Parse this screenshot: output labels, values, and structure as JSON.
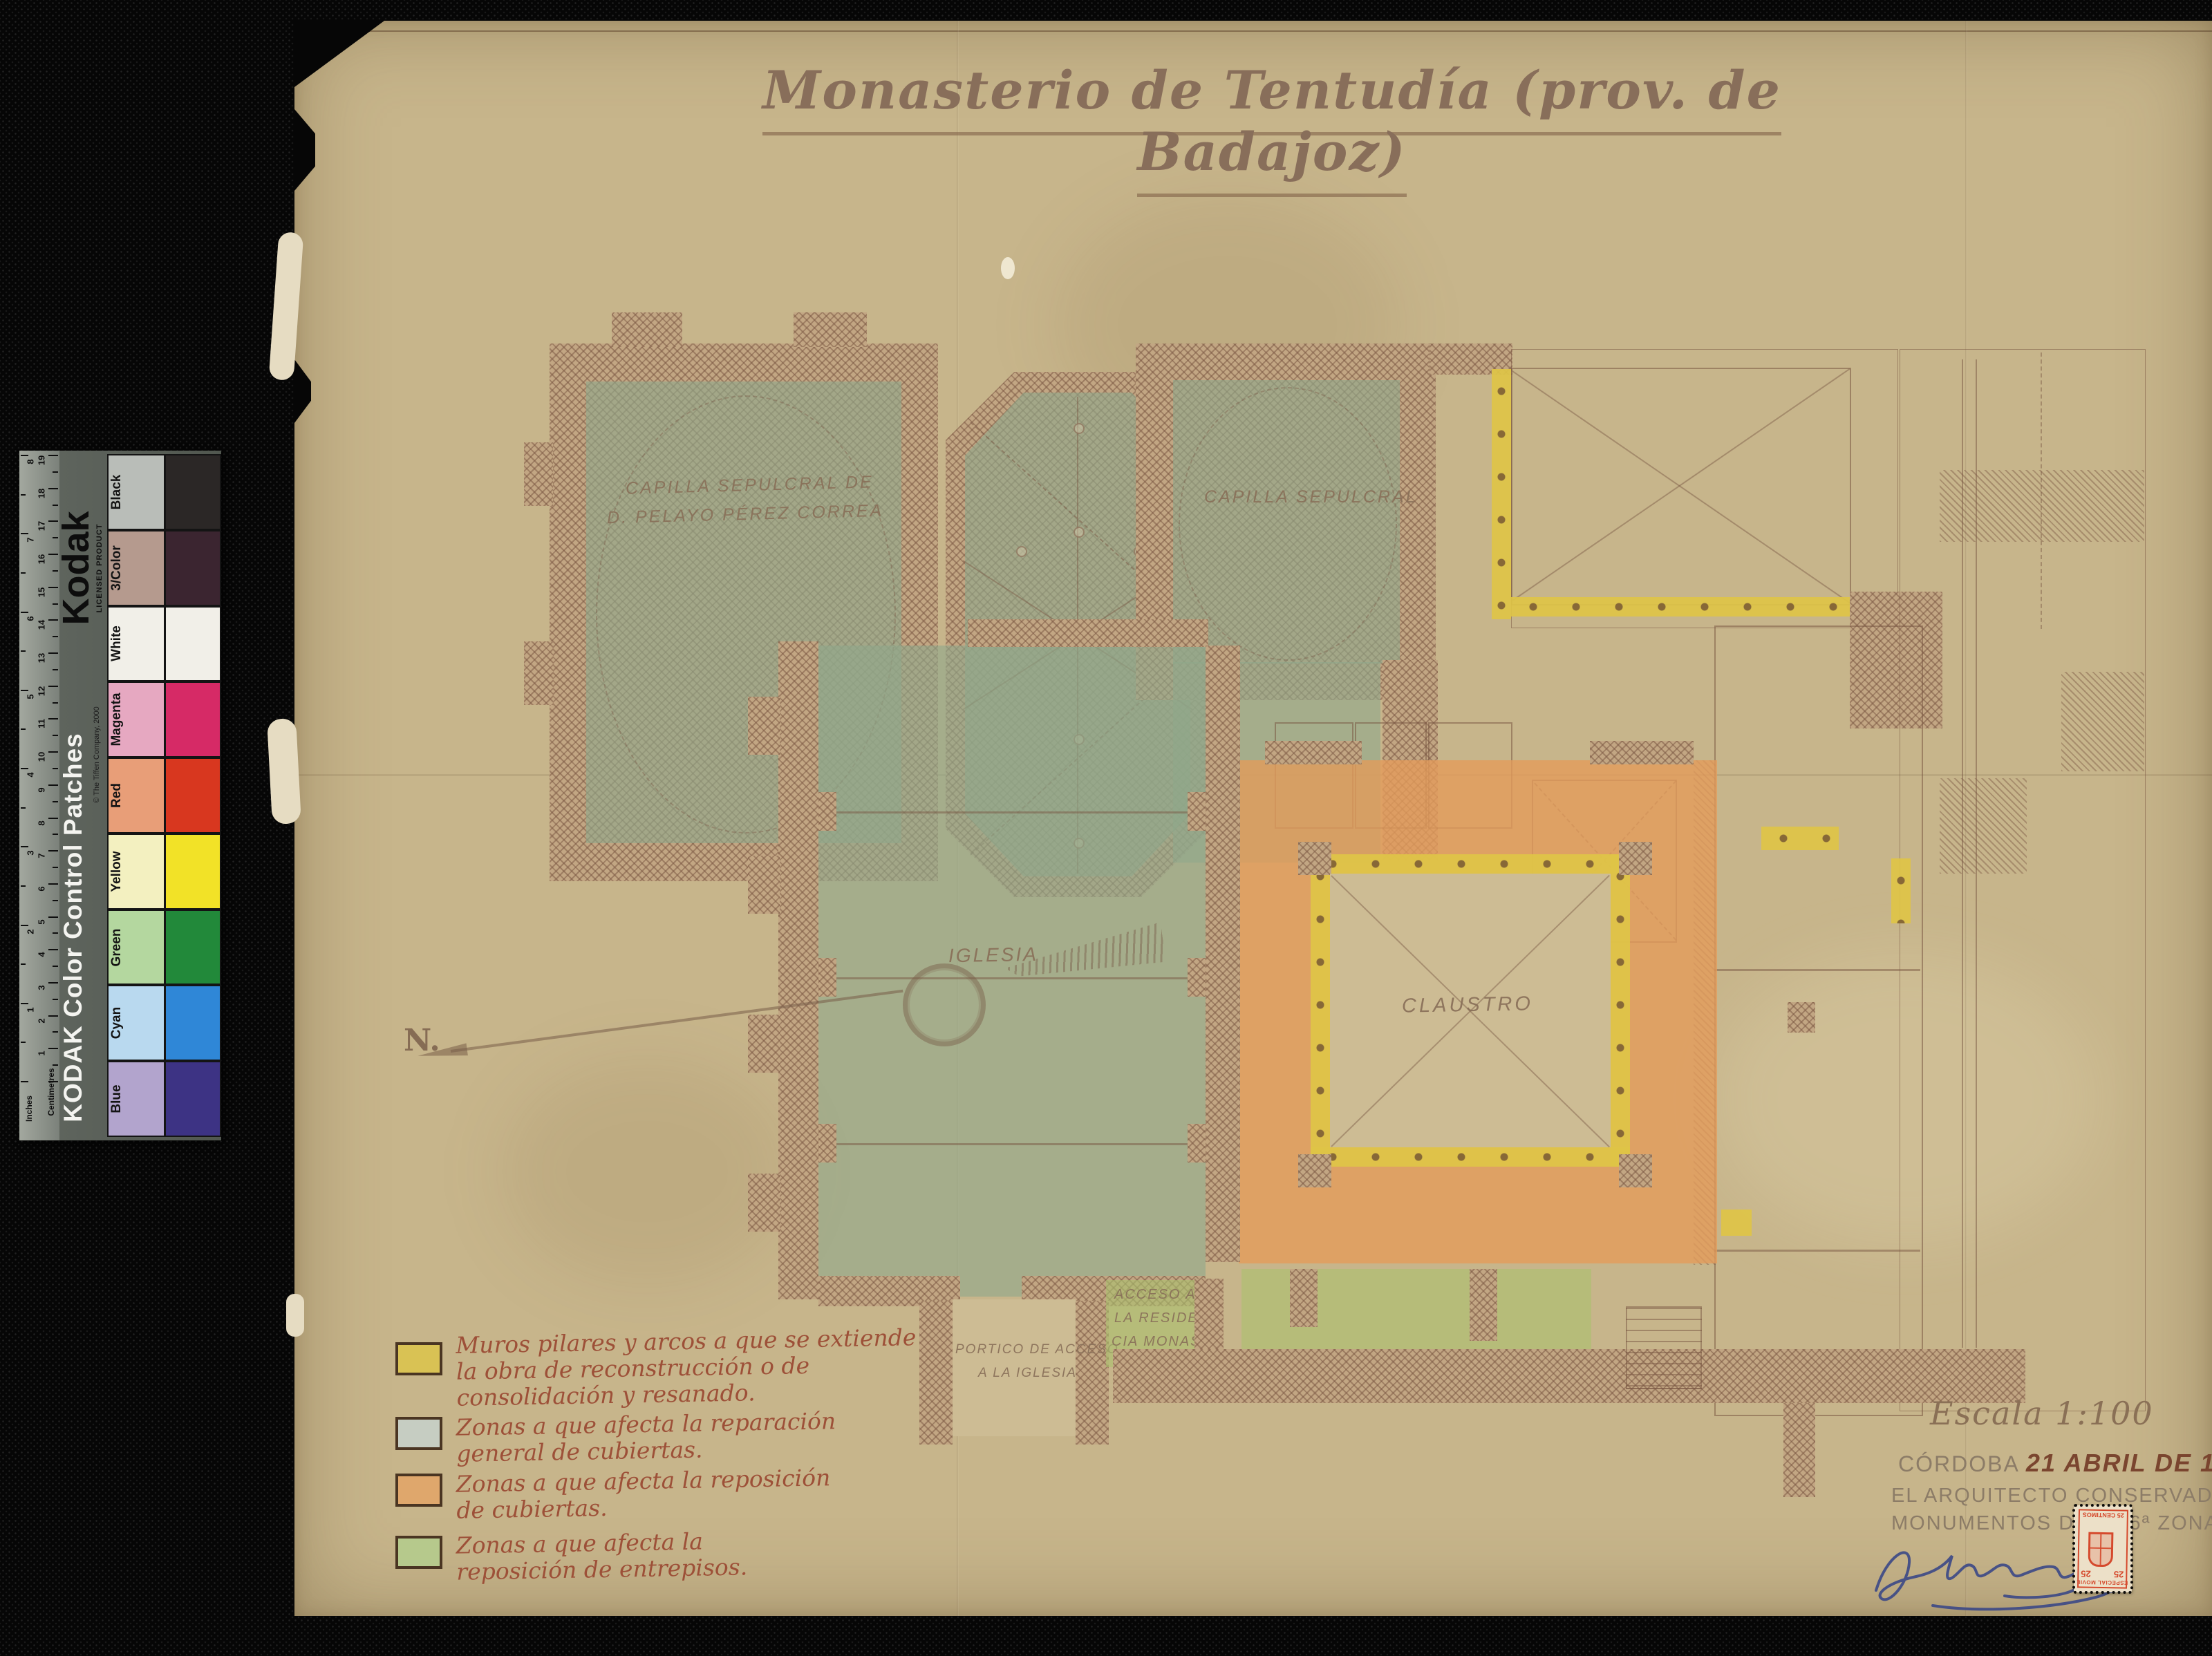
{
  "artwork": {
    "title": "Monasterio de Tentudía (prov. de Badajoz)",
    "scale_label": "Escala 1:100",
    "place": "CÓRDOBA",
    "date": "21 ABRIL DE 1955",
    "architect_lines": [
      "EL ARQUITECTO CONSERVADOR DE",
      "MONUMENTOS DE LA 6ª ZONA."
    ]
  },
  "plan": {
    "north_label": "N.",
    "rooms": {
      "capilla_pelayo_lines": [
        "CAPILLA SEPULCRAL DE",
        "D. PELAYO PÉREZ CORREA"
      ],
      "capilla_sepulcral": "CAPILLA SEPULCRAL",
      "iglesia": "IGLESIA",
      "claustro": "CLAUSTRO",
      "portico_lines": [
        "PORTICO DE ACCESO",
        "A LA IGLESIA"
      ],
      "acceso_lines": [
        "ACCESO A",
        "LA RESIDEN-",
        "CIA MONAS-",
        "TICA."
      ]
    }
  },
  "legend": {
    "items": [
      {
        "color": "#d9c254",
        "lines": [
          "Muros pilares y arcos a que se extiende",
          "la obra de reconstrucción o de",
          "consolidación y resanado."
        ]
      },
      {
        "color": "#c6cdc2",
        "lines": [
          "Zonas a que afecta la reparación",
          "general de cubiertas."
        ]
      },
      {
        "color": "#dfa76c",
        "lines": [
          "Zonas a que afecta la reposición",
          "de cubiertas."
        ]
      },
      {
        "color": "#b6c98c",
        "lines": [
          "Zonas a que afecta la",
          "reposición de entrepisos."
        ]
      }
    ]
  },
  "kodak": {
    "brand": "Kodak",
    "licensed": "LICENSED PRODUCT",
    "product": "KODAK Color Control Patches",
    "copyright": "© The Tiffen Company, 2000",
    "ruler": {
      "cm_label": "Centimetres",
      "in_label": "Inches",
      "cm_max": 19,
      "in_max": 8
    },
    "patches": [
      {
        "name": "Black",
        "light": "#b9bdb8",
        "solid": "#2b2726"
      },
      {
        "name": "3/Color",
        "light": "#b59a8e",
        "solid": "#3b2530"
      },
      {
        "name": "White",
        "light": "#f1efe8",
        "solid": "#f1efe8"
      },
      {
        "name": "Magenta",
        "light": "#e6a8c1",
        "solid": "#d62a66"
      },
      {
        "name": "Red",
        "light": "#e89e78",
        "solid": "#d8371f"
      },
      {
        "name": "Yellow",
        "light": "#f3f0c0",
        "solid": "#f2e227"
      },
      {
        "name": "Green",
        "light": "#b4d79f",
        "solid": "#22893a"
      },
      {
        "name": "Cyan",
        "light": "#b9d9ef",
        "solid": "#2f87d7"
      },
      {
        "name": "Blue",
        "light": "#b2a4cd",
        "solid": "#3d3384"
      }
    ]
  },
  "stamp": {
    "value": "25",
    "unit": "CENTIMOS",
    "series": "ESPECIAL MOVIL"
  }
}
